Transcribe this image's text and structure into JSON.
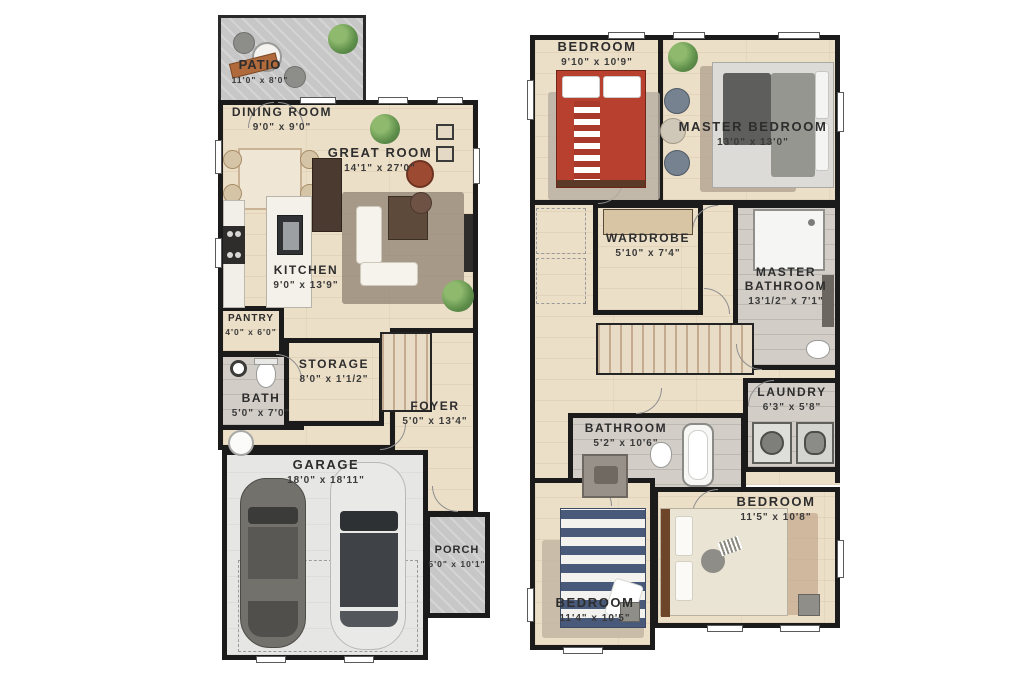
{
  "floor1": {
    "rooms": [
      {
        "name": "PATIO",
        "dims": "11'0\" x 8'0\""
      },
      {
        "name": "DINING ROOM",
        "dims": "9'0\" x 9'0\""
      },
      {
        "name": "GREAT ROOM",
        "dims": "14'1\" x 27'0\""
      },
      {
        "name": "KITCHEN",
        "dims": "9'0\" x 13'9\""
      },
      {
        "name": "PANTRY",
        "dims": "4'0\" x 6'0\""
      },
      {
        "name": "BATH",
        "dims": "5'0\" x 7'0\""
      },
      {
        "name": "STORAGE",
        "dims": "8'0\" x 1'1/2\""
      },
      {
        "name": "FOYER",
        "dims": "5'0\" x 13'4\""
      },
      {
        "name": "GARAGE",
        "dims": "18'0\" x 18'11\""
      },
      {
        "name": "PORCH",
        "dims": "5'0\" x 10'1\""
      }
    ]
  },
  "floor2": {
    "rooms": [
      {
        "name": "BEDROOM",
        "dims": "9'10\" x 10'9\""
      },
      {
        "name": "MASTER BEDROOM",
        "dims": "13'0\" x 13'0\""
      },
      {
        "name": "WARDROBE",
        "dims": "5'10\" x 7'4\""
      },
      {
        "name": "MASTER BATHROOM",
        "dims": "13'1/2\" x 7'1\""
      },
      {
        "name": "LAUNDRY",
        "dims": "6'3\" x 5'8\""
      },
      {
        "name": "BATHROOM",
        "dims": "5'2\" x 10'6\""
      },
      {
        "name": "BEDROOM",
        "dims": "11'5\" x 10'8\""
      },
      {
        "name": "BEDROOM",
        "dims": "11'4\" x 10'5\""
      }
    ]
  },
  "colors": {
    "wall": "#1b1b1b",
    "wood_floor": "#ecdfc8",
    "tile_floor": "#d3cdc8",
    "concrete": "#c7c7c7",
    "garage_floor": "#e6e6e4",
    "accent_red_bed": "#b8402f",
    "accent_navy_bed": "#48597a",
    "label_text": "#2d2d2d"
  }
}
